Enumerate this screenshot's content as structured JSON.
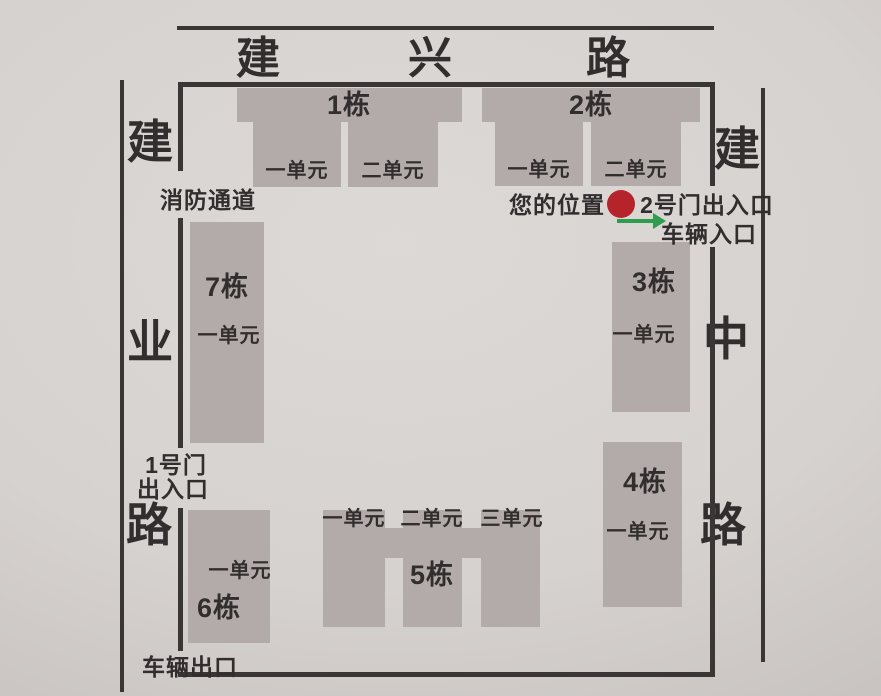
{
  "roads": {
    "top": {
      "name": "建兴路",
      "chars": [
        "建",
        "兴",
        "路"
      ]
    },
    "left": {
      "name": "建业路",
      "chars": [
        "建",
        "业",
        "路"
      ]
    },
    "right": {
      "name": "建中路",
      "chars": [
        "建",
        "中",
        "路"
      ]
    }
  },
  "buildings": {
    "b1": {
      "label": "1栋",
      "units": [
        "一单元",
        "二单元"
      ]
    },
    "b2": {
      "label": "2栋",
      "units": [
        "一单元",
        "二单元"
      ]
    },
    "b3": {
      "label": "3栋",
      "units": [
        "一单元"
      ]
    },
    "b4": {
      "label": "4栋",
      "units": [
        "一单元"
      ]
    },
    "b5": {
      "label": "5栋",
      "units": [
        "一单元",
        "二单元",
        "三单元"
      ]
    },
    "b6": {
      "label": "6栋",
      "units": [
        "一单元"
      ]
    },
    "b7": {
      "label": "7栋",
      "units": [
        "一单元"
      ]
    }
  },
  "labels": {
    "fire_lane": "消防通道",
    "gate1_line1": "1号门",
    "gate1_line2": "出入口",
    "vehicle_exit": "车辆出口",
    "your_location": "您的位置",
    "gate2": "2号门出入口",
    "vehicle_entrance": "车辆入口"
  },
  "colors": {
    "background": "#d7d3d1",
    "building": "#b2abaa",
    "line": "#3b3636",
    "text": "#332e2e",
    "location_marker": "#b6242b",
    "entrance_arrow": "#2e9d4e"
  }
}
